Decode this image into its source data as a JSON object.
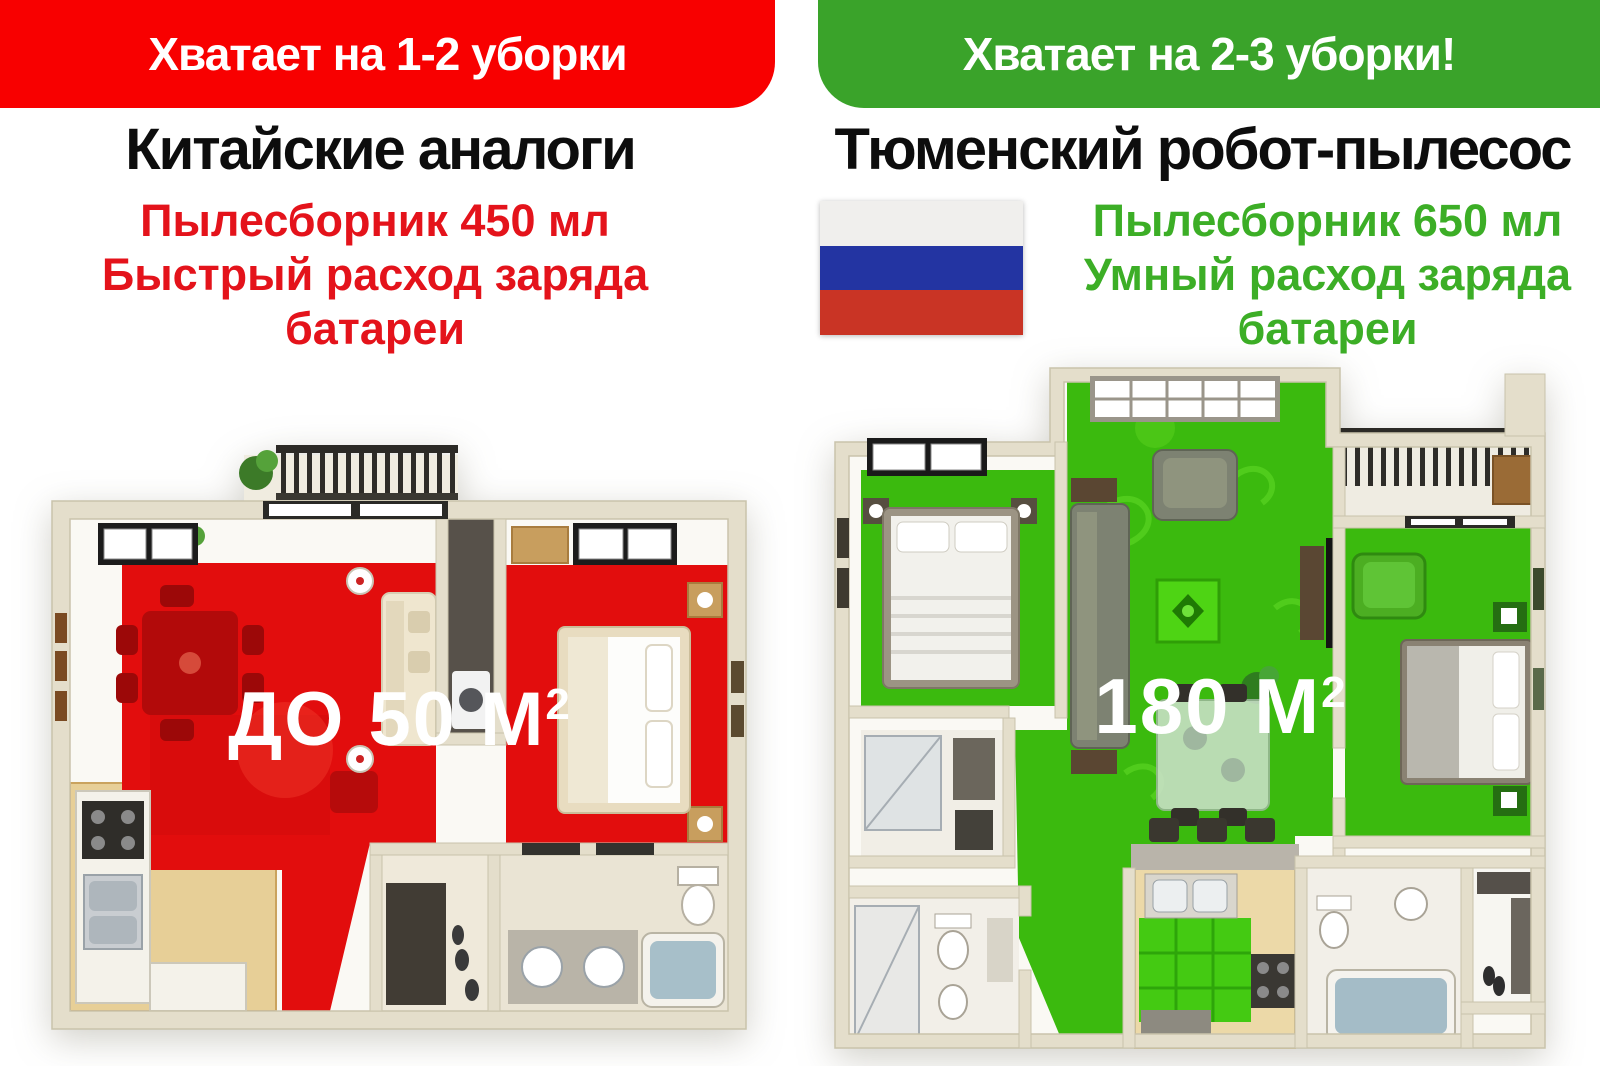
{
  "left": {
    "banner_label": "Хватает на 1-2 уборки",
    "title": "Китайские аналоги",
    "feature_lines": [
      "Пылесборник 450 мл",
      "Быстрый расход заряда",
      "батареи"
    ],
    "area_value": "ДО 50 М",
    "area_superscript": "2"
  },
  "right": {
    "banner_label": "Хватает на 2-3 уборки!",
    "title": "Тюменский робот-пылесос",
    "feature_lines": [
      "Пылесборник 650 мл",
      "Умный расход заряда",
      "батареи"
    ],
    "area_value": "180 М",
    "area_superscript": "2"
  },
  "icons": {
    "flag": "russia-flag"
  },
  "colors": {
    "banner_red": "#f80000",
    "banner_green": "#3aa32a",
    "text_red": "#e4131b",
    "text_green": "#3cae26",
    "zone_red": "#e20d0d",
    "zone_green": "#3bba0e",
    "flag_white": "#f0efed",
    "flag_blue": "#2334a2",
    "flag_red": "#c93425",
    "wall_beige": "#e4decb",
    "area_label_color": "#ffffff"
  }
}
